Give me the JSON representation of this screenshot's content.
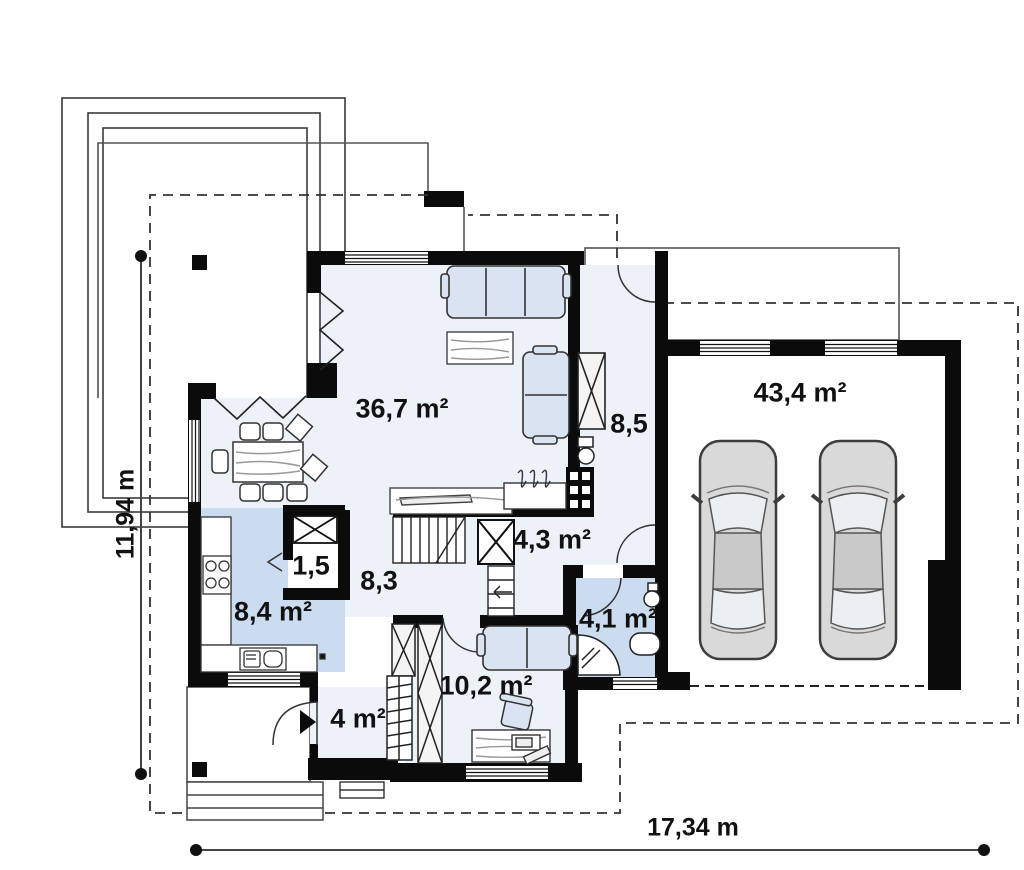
{
  "plan": {
    "rooms": [
      {
        "id": "living-room",
        "area": "36,7 m²"
      },
      {
        "id": "hall-upper",
        "area": "8,5"
      },
      {
        "id": "garage",
        "area": "43,4 m²"
      },
      {
        "id": "pantry",
        "area": "1,5"
      },
      {
        "id": "stair-hall",
        "area": "8,3"
      },
      {
        "id": "kitchen",
        "area": "8,4 m²"
      },
      {
        "id": "corridor",
        "area": "4,3 m²"
      },
      {
        "id": "bathroom",
        "area": "4,1 m²"
      },
      {
        "id": "office",
        "area": "10,2 m²"
      },
      {
        "id": "vestibule",
        "area": "4 m²"
      }
    ],
    "dimensions": {
      "width_label": "17,34 m",
      "height_label": "11,94 m"
    },
    "garage_info": {
      "cars_parked": 2
    },
    "icons": [
      "sofa-3seat-icon",
      "sofa-2seat-icon",
      "coffee-table-icon",
      "dining-table-icon",
      "chair-icon",
      "kitchen-hob-icon",
      "kitchen-sink-icon",
      "stairs-icon",
      "fireplace-icon",
      "wardrobe-icon",
      "toilet-icon",
      "shower-icon",
      "washbasin-icon",
      "desk-icon",
      "office-chair-icon",
      "car-icon",
      "entry-arrow-icon",
      "door-arc-icon",
      "window-icon",
      "chimney-icon"
    ],
    "colors": {
      "wall": "#0b0b0b",
      "room_fill": "#edf1f8",
      "wet_room_fill": "#ccdcf0",
      "furniture_fill": "#d9e3f2",
      "car_fill": "#d9d9d9",
      "outline": "#3a3a3a"
    }
  }
}
